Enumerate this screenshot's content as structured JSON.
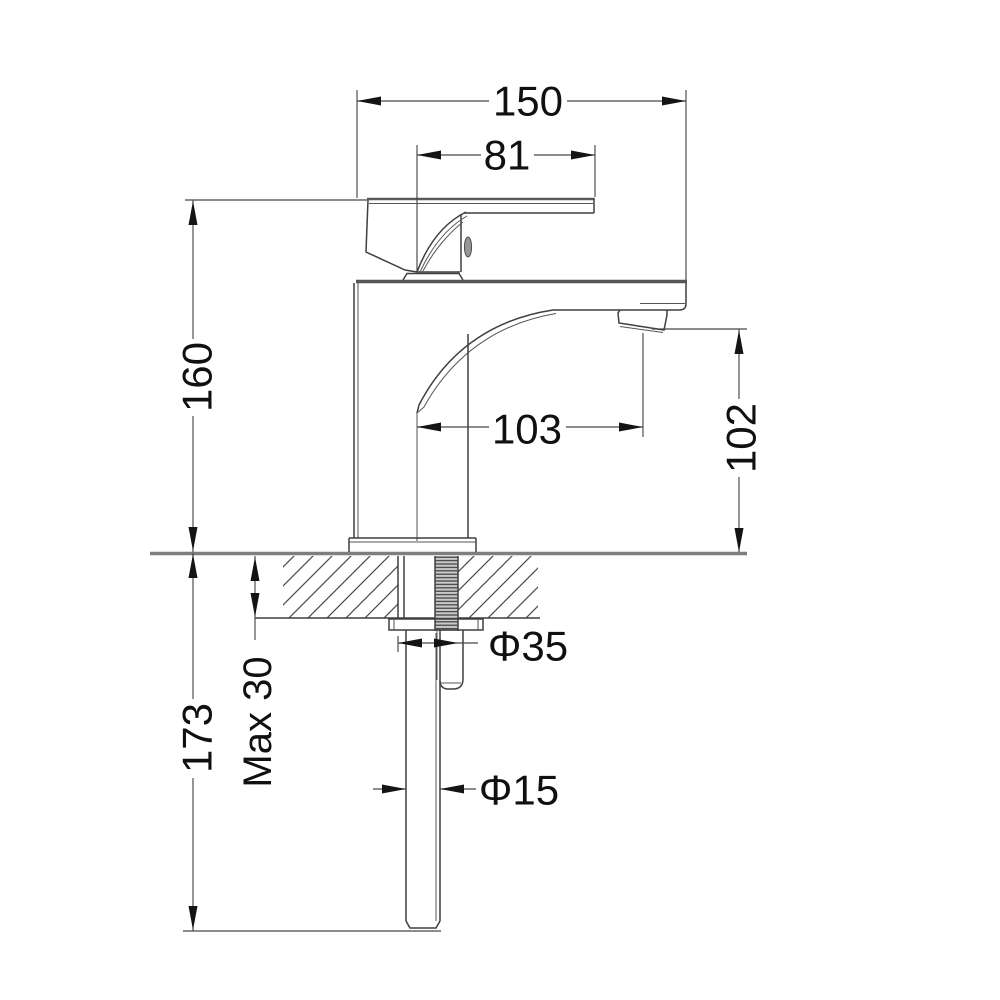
{
  "dimensions": {
    "top_width": "150",
    "handle_reach": "81",
    "height_above_deck": "160",
    "spout_reach": "103",
    "spout_outlet_height": "102",
    "deck_thickness_max": "Max 30",
    "under_deck_length": "173",
    "mounting_hole_dia": "Φ35",
    "inlet_pipe_dia": "Φ15"
  }
}
